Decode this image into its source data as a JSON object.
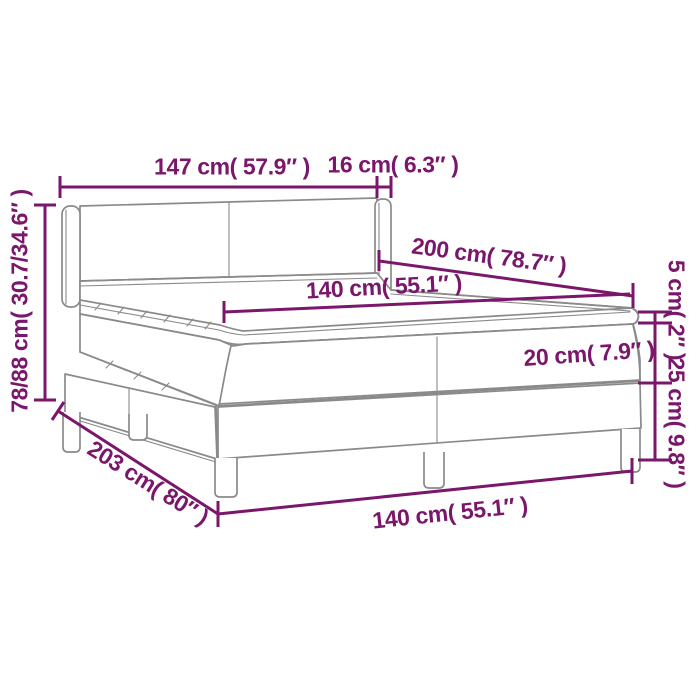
{
  "colors": {
    "dimension": "#7A176B",
    "outline": "#8A8A8A",
    "background": "#FFFFFF"
  },
  "diagram": {
    "type": "product-dimension-diagram",
    "subject": "box spring bed with headboard, pillow-top mattress and legs",
    "labels": {
      "headboard_width": "147 cm( 57.9″ )",
      "wing_depth": "16 cm( 6.3″ )",
      "headboard_height": "78/88 cm( 30.7/34.6″ )",
      "bed_length": "200 cm( 78.7″ )",
      "mattress_width_top": "140 cm( 55.1″ )",
      "topper_height": "5 cm( 2″ )",
      "mattress_height": "20 cm( 7.9″ )",
      "base_height": "25 cm( 9.8″ )",
      "base_length": "203 cm( 80″ )",
      "base_width": "140 cm( 55.1″ )"
    }
  }
}
